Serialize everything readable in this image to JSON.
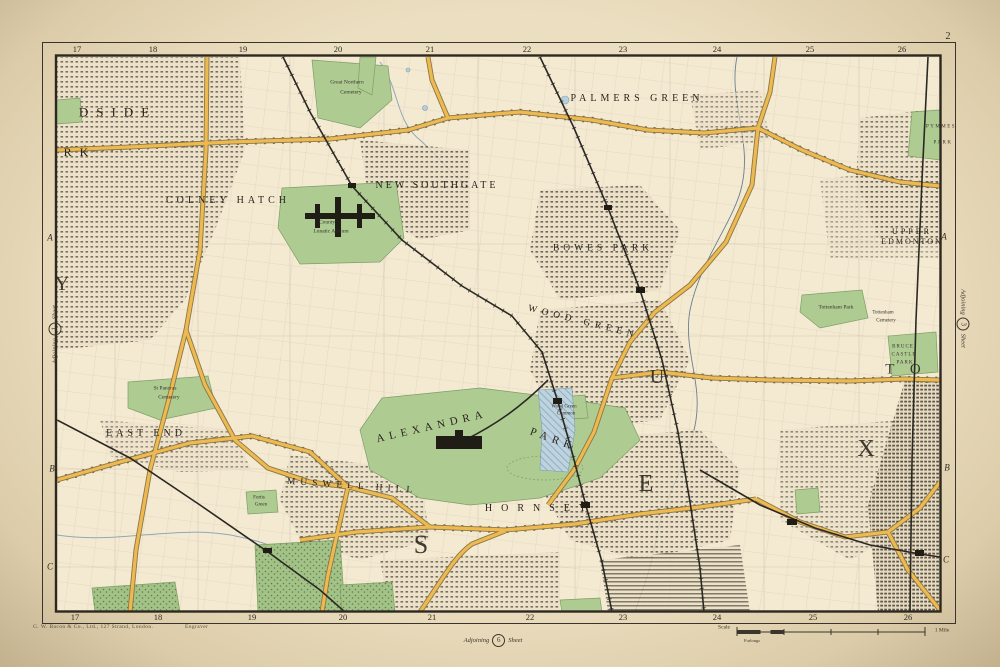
{
  "page": {
    "sheet_number": "2",
    "imprint_left": "G. W. Bacon & Co., Ltd., 127 Strand, London.",
    "imprint_right": "Engraver",
    "adjoining": {
      "left": {
        "prefix": "Adjoining",
        "number": "1",
        "suffix": "Sheet"
      },
      "right": {
        "prefix": "Adjoining",
        "number": "3",
        "suffix": "Sheet"
      },
      "bottom": {
        "prefix": "Adjoining",
        "number": "6",
        "suffix": "Sheet"
      }
    },
    "scale_bar": {
      "label": "Scale",
      "sub_label": "Furlongs",
      "end_label": "1 Mile"
    }
  },
  "grid": {
    "top": [
      "17",
      "18",
      "19",
      "20",
      "21",
      "22",
      "23",
      "24",
      "25",
      "26"
    ],
    "bottom": [
      "17",
      "18",
      "19",
      "20",
      "21",
      "22",
      "23",
      "24",
      "25",
      "26"
    ],
    "left": [
      "A",
      "B",
      "C"
    ],
    "right": [
      "A",
      "B",
      "C"
    ]
  },
  "labels": {
    "districts": [
      {
        "text": "COLNEY HATCH",
        "x": 228,
        "y": 201,
        "fs": 10,
        "ls": 4,
        "rot": 0
      },
      {
        "text": "NEW SOUTHGATE",
        "x": 437,
        "y": 186,
        "fs": 10,
        "ls": 3,
        "rot": 0
      },
      {
        "text": "PALMERS GREEN",
        "x": 637,
        "y": 99,
        "fs": 10,
        "ls": 4,
        "rot": 0
      },
      {
        "text": "BOWES PARK",
        "x": 603,
        "y": 249,
        "fs": 9.5,
        "ls": 4,
        "rot": 0
      },
      {
        "text": "UPPER",
        "x": 912,
        "y": 232,
        "fs": 8,
        "ls": 3,
        "rot": 0
      },
      {
        "text": "EDMONTON",
        "x": 912,
        "y": 242,
        "fs": 8,
        "ls": 2,
        "rot": 0
      },
      {
        "text": "ALEXANDRA",
        "x": 432,
        "y": 427,
        "fs": 11,
        "ls": 5,
        "rot": -13
      },
      {
        "text": "PARK",
        "x": 553,
        "y": 440,
        "fs": 11,
        "ls": 5,
        "rot": 20
      },
      {
        "text": "HORNSEY",
        "x": 540,
        "y": 509,
        "fs": 10,
        "ls": 9,
        "rot": 0
      },
      {
        "text": "MUSWELL HILL",
        "x": 352,
        "y": 487,
        "fs": 9.5,
        "ls": 5,
        "rot": 4
      },
      {
        "text": "EAST END",
        "x": 146,
        "y": 434,
        "fs": 10,
        "ls": 4,
        "rot": 0
      },
      {
        "text": "WOOD GREEN",
        "x": 583,
        "y": 323,
        "fs": 9.5,
        "ls": 5,
        "rot": 14
      },
      {
        "text": "DSIDE",
        "x": 118,
        "y": 112,
        "fs": 13,
        "ls": 8,
        "rot": 0
      },
      {
        "text": "RK",
        "x": 80,
        "y": 152,
        "fs": 12,
        "ls": 8,
        "rot": 0
      }
    ],
    "big_letters": [
      {
        "text": "Y",
        "x": 62,
        "y": 284,
        "fs": 20
      },
      {
        "text": "S",
        "x": 421,
        "y": 545,
        "fs": 26
      },
      {
        "text": "E",
        "x": 646,
        "y": 484,
        "fs": 24
      },
      {
        "text": "U",
        "x": 657,
        "y": 377,
        "fs": 20
      },
      {
        "text": "X",
        "x": 866,
        "y": 449,
        "fs": 24
      },
      {
        "text": "T O",
        "x": 906,
        "y": 370,
        "fs": 15,
        "ls": 6
      }
    ],
    "places": [
      {
        "text": "Great Northern",
        "x": 347,
        "y": 83,
        "fs": 5.5
      },
      {
        "text": "Cemetery",
        "x": 351,
        "y": 93,
        "fs": 5.5
      },
      {
        "text": "County",
        "x": 327,
        "y": 223,
        "fs": 5.5
      },
      {
        "text": "Lunatic Asylum",
        "x": 331,
        "y": 232,
        "fs": 5.5
      },
      {
        "text": "St Pancras",
        "x": 165,
        "y": 389,
        "fs": 5.5
      },
      {
        "text": "Cemetery",
        "x": 169,
        "y": 398,
        "fs": 5.5
      },
      {
        "text": "Tottenham Park",
        "x": 836,
        "y": 308,
        "fs": 5.5
      },
      {
        "text": "Tottenham",
        "x": 883,
        "y": 313,
        "fs": 5
      },
      {
        "text": "Cemetery",
        "x": 886,
        "y": 321,
        "fs": 5
      },
      {
        "text": "BRUCE",
        "x": 903,
        "y": 347,
        "fs": 5,
        "ls": 1
      },
      {
        "text": "CASTLE",
        "x": 904,
        "y": 355,
        "fs": 5,
        "ls": 1
      },
      {
        "text": "PARK",
        "x": 905,
        "y": 363,
        "fs": 5,
        "ls": 1
      },
      {
        "text": "PYMMES",
        "x": 941,
        "y": 127,
        "fs": 5,
        "ls": 1.5
      },
      {
        "text": "PARK",
        "x": 943,
        "y": 143,
        "fs": 5,
        "ls": 1.5
      },
      {
        "text": "Wood Green",
        "x": 564,
        "y": 407,
        "fs": 5
      },
      {
        "text": "Common",
        "x": 566,
        "y": 414,
        "fs": 5
      },
      {
        "text": "Fortis",
        "x": 259,
        "y": 498,
        "fs": 5
      },
      {
        "text": "Green",
        "x": 261,
        "y": 505,
        "fs": 5
      }
    ]
  },
  "colors": {
    "paper": "#e8dcbe",
    "map_face": "#f4ead2",
    "park_green": "#aecb92",
    "wood_green": "#a3c287",
    "road_yellow": "#eeb951",
    "rail_black": "#2b2823",
    "water_blue": "#b9d0dc",
    "frame_ink": "#3a352c"
  }
}
